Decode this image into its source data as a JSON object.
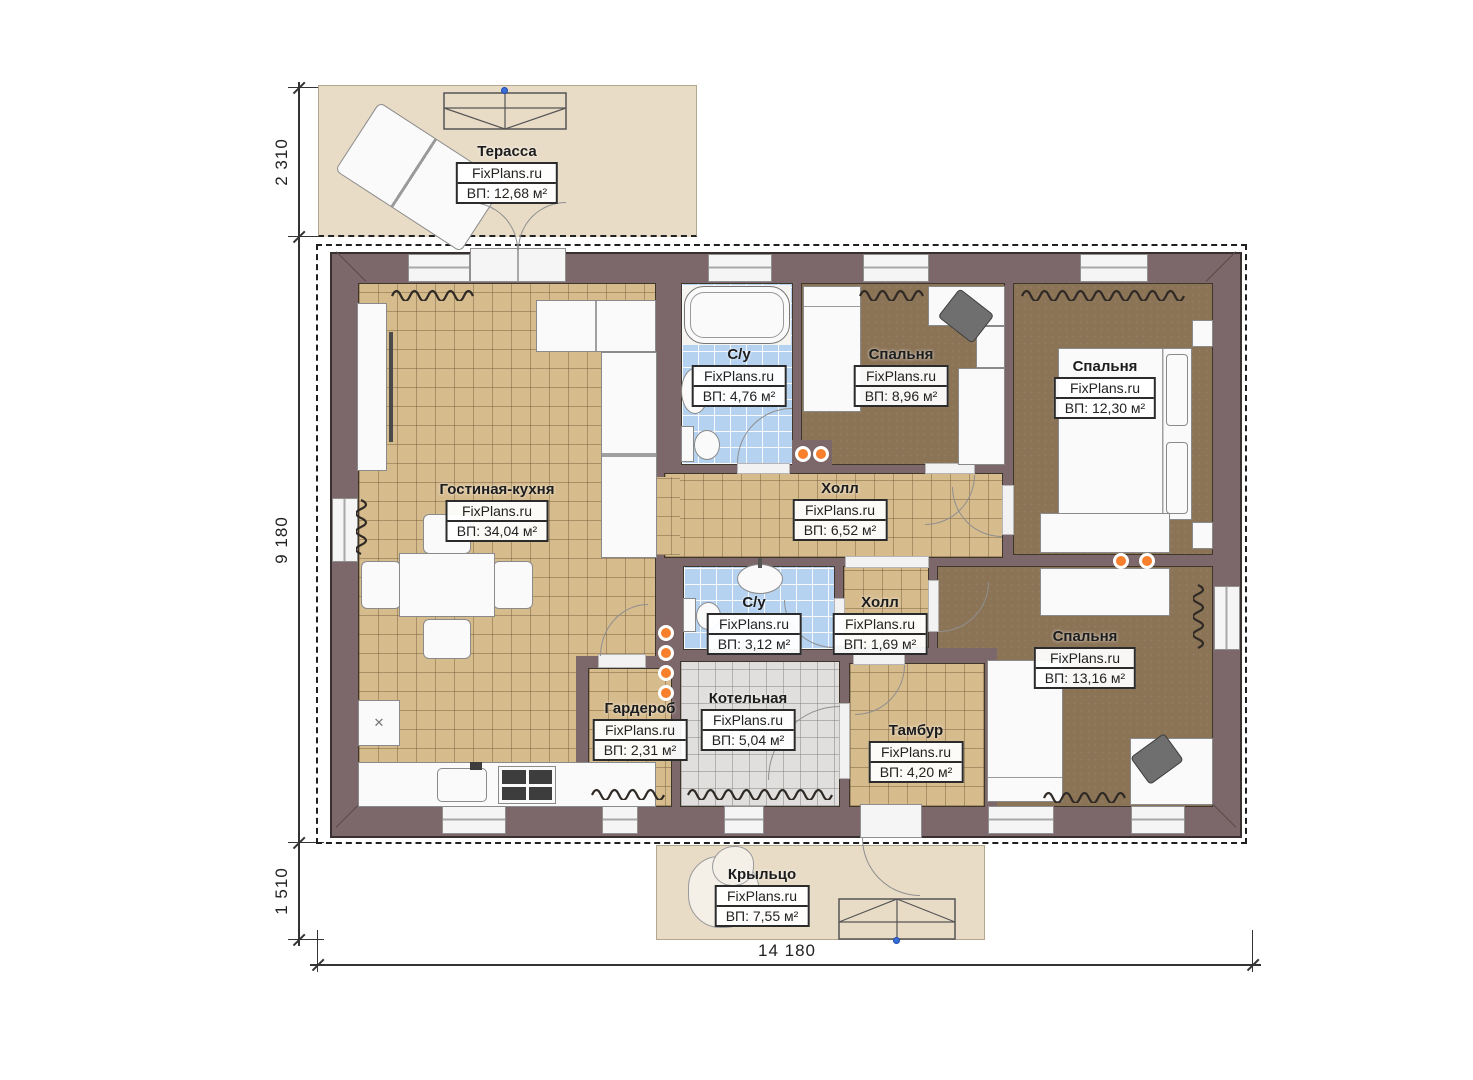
{
  "watermark": "FixPlans.ru",
  "dimensions": {
    "terrace_height": "2 310",
    "house_height": "9 180",
    "porch_height": "1 510",
    "house_width": "14 180"
  },
  "rooms": {
    "terrace": {
      "name": "Терасса",
      "area": "ВП: 12,68 м²"
    },
    "living": {
      "name": "Гостиная-кухня",
      "area": "ВП: 34,04 м²"
    },
    "bath_top": {
      "name": "С/у",
      "area": "ВП: 4,76 м²"
    },
    "bedroom_top": {
      "name": "Спальня",
      "area": "ВП: 8,96 м²"
    },
    "bedroom_right": {
      "name": "Спальня",
      "area": "ВП: 12,30 м²"
    },
    "hall_main": {
      "name": "Холл",
      "area": "ВП: 6,52 м²"
    },
    "bath_mid": {
      "name": "С/у",
      "area": "ВП: 3,12 м²"
    },
    "hall_small": {
      "name": "Холл",
      "area": "ВП: 1,69 м²"
    },
    "bedroom_bottom": {
      "name": "Спальня",
      "area": "ВП: 13,16 м²"
    },
    "wardrobe": {
      "name": "Гардероб",
      "area": "ВП: 2,31 м²"
    },
    "boiler": {
      "name": "Котельная",
      "area": "ВП: 5,04 м²"
    },
    "vestibule": {
      "name": "Тамбур",
      "area": "ВП: 4,20 м²"
    },
    "porch": {
      "name": "Крыльцо",
      "area": "ВП: 7,55 м²"
    }
  },
  "symbols": {
    "fridge": "✕"
  },
  "colors": {
    "wall": "#7c676a",
    "terrace_floor": "#e8dcc7",
    "living_tile": "#d6bb8d",
    "bedroom_floor": "#8b7356",
    "bath_tile": "#b5d2f0",
    "boiler_tile": "#e0dfdd",
    "accent_dot": "#f87f2c"
  }
}
